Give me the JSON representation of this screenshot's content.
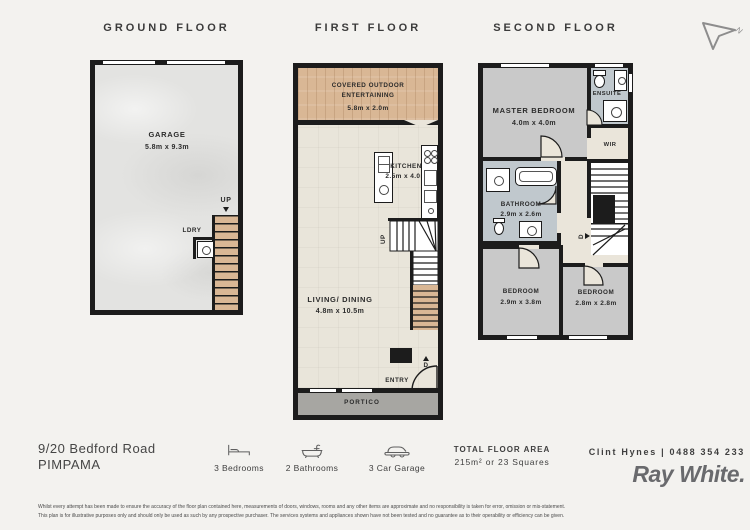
{
  "page": {
    "compass_label": "N"
  },
  "floors": {
    "ground": {
      "title": "GROUND FLOOR",
      "rooms": {
        "garage": {
          "name": "GARAGE",
          "dims": "5.8m x 9.3m"
        },
        "ldry": "LDRY",
        "up": "UP"
      }
    },
    "first": {
      "title": "FIRST FLOOR",
      "rooms": {
        "outdoor": {
          "name_line1": "COVERED OUTDOOR",
          "name_line2": "ENTERTAINING",
          "dims": "5.8m x 2.0m"
        },
        "kitchen": {
          "name": "KITCHEN",
          "dims": "2.5m x 4.0m"
        },
        "living": {
          "name": "LIVING/ DINING",
          "dims": "4.8m x 10.5m"
        },
        "entry": "ENTRY",
        "portico": "PORTICO",
        "up": "UP",
        "door": "D"
      }
    },
    "second": {
      "title": "SECOND FLOOR",
      "rooms": {
        "master": {
          "name": "MASTER BEDROOM",
          "dims": "4.0m x 4.0m"
        },
        "ensuite": "ENSUITE",
        "wir": "WIR",
        "bathroom": {
          "name": "BATHROOM",
          "dims": "2.9m x 2.6m"
        },
        "bedroom2": {
          "name": "BEDROOM",
          "dims": "2.9m x 3.8m"
        },
        "bedroom3": {
          "name": "BEDROOM",
          "dims": "2.8m x 2.8m"
        },
        "door": "D"
      }
    }
  },
  "footer": {
    "address_line1": "9/20 Bedford Road",
    "address_line2": "PIMPAMA",
    "features": [
      {
        "icon": "bed-icon",
        "label": "3 Bedrooms"
      },
      {
        "icon": "bath-icon",
        "label": "2 Bathrooms"
      },
      {
        "icon": "car-icon",
        "label": "3 Car Garage"
      }
    ],
    "total_area_title": "TOTAL FLOOR AREA",
    "total_area_value": "215m² or 23 Squares",
    "agent": "Clint Hynes | 0488 354 233",
    "brand": "Ray White.",
    "disclaimer_line1": "Whilst every attempt has been made to ensure the accuracy of the floor plan contained here, measurements of doors, windows, rooms and any other items are approximate and no responsibility is taken for error, omission or mis-statement.",
    "disclaimer_line2": "This plan is for illustrative purposes only and should only be used as such by any prospective purchaser. The services systems and appliances shown have not been tested and no guarantee as to their operability or efficiency can be given."
  },
  "colors": {
    "wall": "#1c1c1c",
    "wood": "#d9b795",
    "carpet": "#c9c9c9",
    "wet_area": "#c0c8cd",
    "floor_beige": "#eae5da",
    "portico": "#a7a6a2",
    "concrete": "#e3e3e1",
    "brand_gray": "#6a6b6e",
    "background": "#f3f2ef"
  }
}
